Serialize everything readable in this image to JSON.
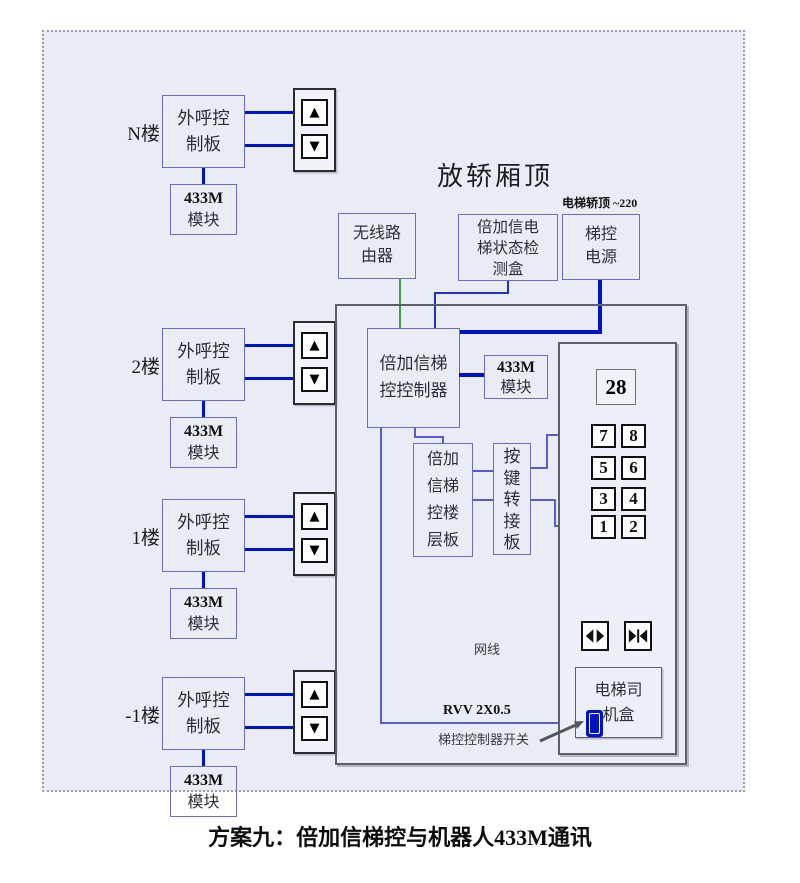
{
  "diagram": {
    "title": "放轿厢顶",
    "top_note": "电梯轿顶 ~220",
    "caption": "方案九：倍加信梯控与机器人433M通讯",
    "wire_labels": {
      "network_cable": "网线",
      "rvv_cable": "RVV 2X0.5",
      "controller_switch": "梯控控制器开关"
    },
    "colors": {
      "background": "#e9ecf6",
      "wire_blue": "#0013c4",
      "wire_violet": "#5b5bd0",
      "wire_green": "#3aa04a",
      "box_border_violet": "#6b6bc4",
      "box_border_gray": "#5f5f6a",
      "switch_blue": "#0013c4"
    }
  },
  "floor_units": {
    "floors": [
      "N楼",
      "2楼",
      "1楼",
      "-1楼"
    ],
    "board_lines": [
      "外呼控",
      "制板"
    ],
    "module_lines": [
      "433M",
      "模块"
    ],
    "up_icon": "▲",
    "down_icon": "▼"
  },
  "cartop": {
    "router_lines": [
      "无线路",
      "由器"
    ],
    "detector_lines": [
      "倍加信电",
      "梯状态检",
      "测盒"
    ],
    "power_lines": [
      "梯控",
      "电源"
    ],
    "controller_lines": [
      "倍加信梯",
      "控控制器"
    ],
    "module_lines": [
      "433M",
      "模块"
    ],
    "floorboard_lines": [
      "倍加",
      "信梯",
      "控楼",
      "层板"
    ],
    "adapter_chars": [
      "按",
      "键",
      "转",
      "接",
      "板"
    ],
    "driver_lines": [
      "电梯司",
      "机盒"
    ],
    "display_value": "28",
    "keypad": [
      [
        "7",
        "8"
      ],
      [
        "5",
        "6"
      ],
      [
        "3",
        "4"
      ],
      [
        "1",
        "2"
      ]
    ],
    "icons": {
      "door_open": "open-door-outward-triangles",
      "door_close": "close-door-inward-triangles"
    }
  }
}
